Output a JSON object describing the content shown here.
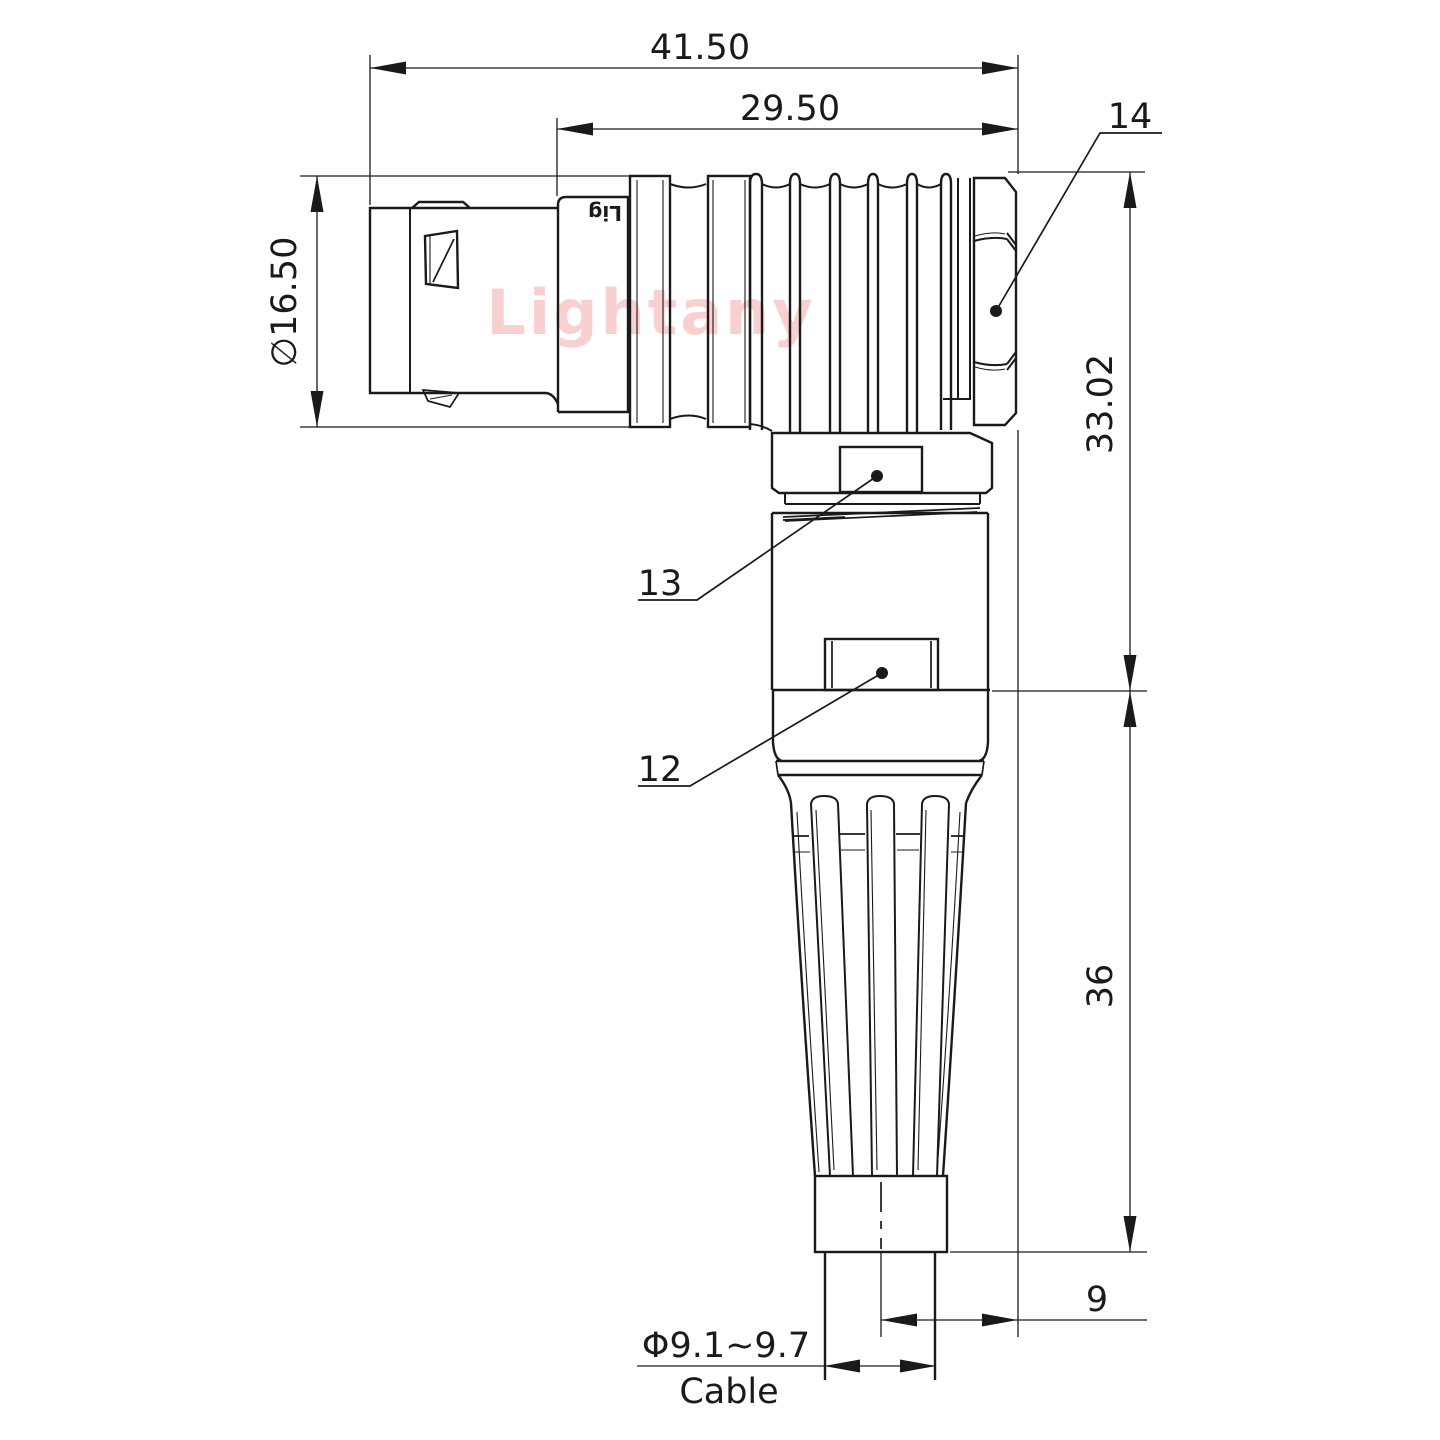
{
  "colors": {
    "line": "#1a1a1a",
    "background": "#ffffff",
    "watermark": "#f8d0d0"
  },
  "watermark": {
    "text": "Lightany"
  },
  "body_marking": {
    "text": "Lig"
  },
  "dimensions": {
    "overall_length": "41.50",
    "rear_length": "29.50",
    "shell_diameter": "∅16.50",
    "upper_height": "33.02",
    "lower_height": "36",
    "cable_offset": "9",
    "cable_diameter": "Φ9.1~9.7",
    "cable_label": "Cable"
  },
  "callouts": [
    {
      "label": "14"
    },
    {
      "label": "13"
    },
    {
      "label": "12"
    }
  ]
}
